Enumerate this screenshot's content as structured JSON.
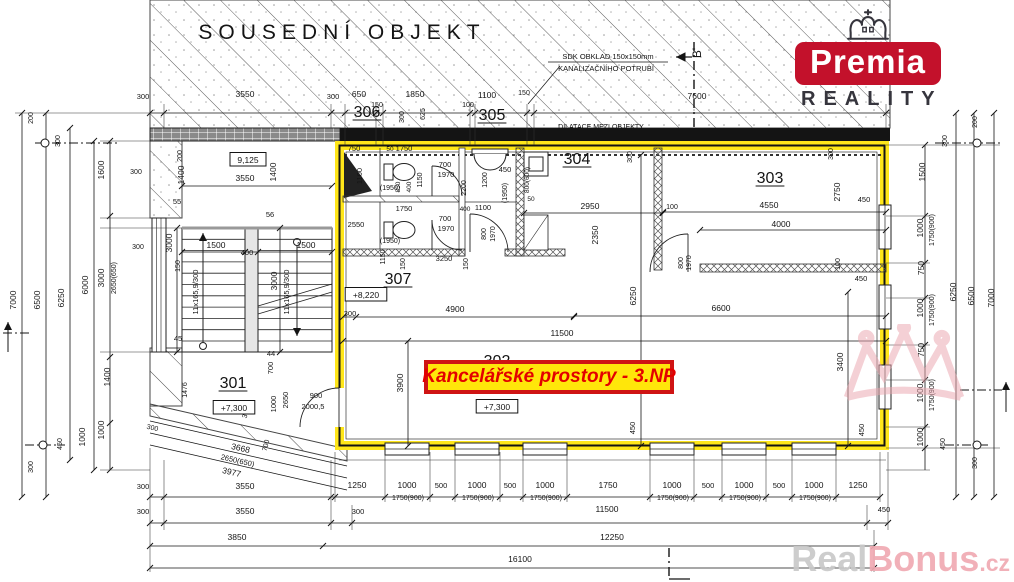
{
  "logo": {
    "name": "Premia",
    "subtitle": "REALITY"
  },
  "label": {
    "text": "Kancelářské prostory - 3.NP"
  },
  "watermark": {
    "part1": "Real",
    "part2": "Bonus",
    "part3": ".cz"
  },
  "colors": {
    "highlight_yellow": "#ffe61a",
    "label_border": "#cf1414",
    "label_text": "#e30000",
    "logo_red": "#c3112b",
    "logo_dark": "#36353d",
    "watermark_gray": "#c9c9c9",
    "watermark_pink": "#f0aab2",
    "line_dark": "#141414"
  },
  "texts": [
    {
      "t": "SOUSEDNÍ OBJEKT",
      "x": 342,
      "y": 39,
      "s": 21,
      "c": "#4d4d4d",
      "ls": 6,
      "n": "neighbor-building-label"
    },
    {
      "t": "SDK OBKLAD 150x150mm",
      "x": 608,
      "y": 59,
      "s": 7.5,
      "n": "note-sdk-cladding"
    },
    {
      "t": "KANALIZAČNÍHO POTRUBÍ",
      "x": 606,
      "y": 71,
      "s": 7.5,
      "n": "note-sewer-pipe"
    },
    {
      "t": "B'",
      "x": 701,
      "y": 53,
      "s": 12,
      "r": -90,
      "n": "section-marker-b"
    },
    {
      "t": "DILATACE MEZI OBJEKTY",
      "x": 601,
      "y": 129,
      "s": 7,
      "n": "note-dilatace"
    },
    {
      "t": "300",
      "x": 143,
      "y": 99,
      "s": 7.5
    },
    {
      "t": "3550",
      "x": 245,
      "y": 97
    },
    {
      "t": "300",
      "x": 333,
      "y": 99,
      "s": 7.5
    },
    {
      "t": "650",
      "x": 359,
      "y": 97
    },
    {
      "t": "150",
      "x": 377,
      "y": 107,
      "s": 7
    },
    {
      "t": "1850",
      "x": 415,
      "y": 97
    },
    {
      "t": "100",
      "x": 468,
      "y": 107,
      "s": 7
    },
    {
      "t": "1100",
      "x": 487,
      "y": 98
    },
    {
      "t": "150",
      "x": 524,
      "y": 95,
      "s": 7
    },
    {
      "t": "7600",
      "x": 697,
      "y": 99
    },
    {
      "t": "300",
      "x": 404,
      "y": 117,
      "r": -90,
      "s": 7
    },
    {
      "t": "625",
      "x": 425,
      "y": 114,
      "r": -90,
      "s": 7
    },
    {
      "t": "306",
      "x": 367,
      "y": 117,
      "s": 16,
      "u": 1,
      "n": "room-306"
    },
    {
      "t": "305",
      "x": 492,
      "y": 120,
      "s": 16,
      "u": 1,
      "n": "room-305"
    },
    {
      "t": "7000",
      "x": 16,
      "y": 300,
      "r": -90
    },
    {
      "t": "6500",
      "x": 40,
      "y": 300,
      "r": -90
    },
    {
      "t": "6250",
      "x": 64,
      "y": 298,
      "r": -90
    },
    {
      "t": "6000",
      "x": 88,
      "y": 285,
      "r": -90
    },
    {
      "t": "200",
      "x": 33,
      "y": 118,
      "r": -90,
      "s": 7
    },
    {
      "t": "300",
      "x": 60,
      "y": 141,
      "r": -90,
      "s": 7
    },
    {
      "t": "1600",
      "x": 104,
      "y": 170,
      "r": -90
    },
    {
      "t": "3000",
      "x": 104,
      "y": 278,
      "r": -90
    },
    {
      "t": "2650(650)",
      "x": 116,
      "y": 278,
      "r": -90,
      "s": 7
    },
    {
      "t": "1400",
      "x": 110,
      "y": 377,
      "r": -90
    },
    {
      "t": "1000",
      "x": 104,
      "y": 430,
      "r": -90
    },
    {
      "t": "1000",
      "x": 85,
      "y": 437,
      "r": -90
    },
    {
      "t": "450",
      "x": 62,
      "y": 444,
      "r": -90,
      "s": 7
    },
    {
      "t": "300",
      "x": 33,
      "y": 467,
      "r": -90,
      "s": 7
    },
    {
      "t": "300",
      "x": 136,
      "y": 174,
      "s": 7
    },
    {
      "t": "300",
      "x": 138,
      "y": 249,
      "s": 7
    },
    {
      "t": "200",
      "x": 977,
      "y": 122,
      "r": -90,
      "s": 7
    },
    {
      "t": "300",
      "x": 947,
      "y": 141,
      "r": -90,
      "s": 7
    },
    {
      "t": "1500",
      "x": 925,
      "y": 172,
      "r": -90
    },
    {
      "t": "1000",
      "x": 923,
      "y": 228,
      "r": -90
    },
    {
      "t": "1750(900)",
      "x": 934,
      "y": 230,
      "r": -90,
      "s": 7
    },
    {
      "t": "750",
      "x": 924,
      "y": 268,
      "r": -90
    },
    {
      "t": "1000",
      "x": 923,
      "y": 308,
      "r": -90
    },
    {
      "t": "1750(900)",
      "x": 934,
      "y": 310,
      "r": -90,
      "s": 7
    },
    {
      "t": "750",
      "x": 924,
      "y": 350,
      "r": -90
    },
    {
      "t": "1000",
      "x": 923,
      "y": 393,
      "r": -90
    },
    {
      "t": "1750(900)",
      "x": 934,
      "y": 395,
      "r": -90,
      "s": 7
    },
    {
      "t": "1000",
      "x": 923,
      "y": 437,
      "r": -90
    },
    {
      "t": "450",
      "x": 945,
      "y": 444,
      "r": -90,
      "s": 7
    },
    {
      "t": "300",
      "x": 977,
      "y": 463,
      "r": -90,
      "s": 7
    },
    {
      "t": "6250",
      "x": 956,
      "y": 292,
      "r": -90
    },
    {
      "t": "6500",
      "x": 974,
      "y": 296,
      "r": -90
    },
    {
      "t": "7000",
      "x": 994,
      "y": 298,
      "r": -90
    },
    {
      "t": "300",
      "x": 143,
      "y": 489,
      "s": 7.5
    },
    {
      "t": "3550",
      "x": 245,
      "y": 489
    },
    {
      "t": "1250",
      "x": 357,
      "y": 488
    },
    {
      "t": "1000",
      "x": 407,
      "y": 488
    },
    {
      "t": "1750(900)",
      "x": 408,
      "y": 500,
      "s": 7
    },
    {
      "t": "500",
      "x": 441,
      "y": 488,
      "s": 7.5
    },
    {
      "t": "1000",
      "x": 477,
      "y": 488
    },
    {
      "t": "1750(900)",
      "x": 478,
      "y": 500,
      "s": 7
    },
    {
      "t": "500",
      "x": 510,
      "y": 488,
      "s": 7.5
    },
    {
      "t": "1000",
      "x": 545,
      "y": 488
    },
    {
      "t": "1750(900)",
      "x": 546,
      "y": 500,
      "s": 7
    },
    {
      "t": "1750",
      "x": 608,
      "y": 488
    },
    {
      "t": "1000",
      "x": 672,
      "y": 488
    },
    {
      "t": "1750(900)",
      "x": 673,
      "y": 500,
      "s": 7
    },
    {
      "t": "500",
      "x": 708,
      "y": 488,
      "s": 7.5
    },
    {
      "t": "1000",
      "x": 744,
      "y": 488
    },
    {
      "t": "1750(900)",
      "x": 745,
      "y": 500,
      "s": 7
    },
    {
      "t": "500",
      "x": 779,
      "y": 488,
      "s": 7.5
    },
    {
      "t": "1000",
      "x": 814,
      "y": 488
    },
    {
      "t": "1750(900)",
      "x": 815,
      "y": 500,
      "s": 7
    },
    {
      "t": "1250",
      "x": 858,
      "y": 488
    },
    {
      "t": "300",
      "x": 143,
      "y": 514,
      "s": 7.5
    },
    {
      "t": "3550",
      "x": 245,
      "y": 514
    },
    {
      "t": "300",
      "x": 358,
      "y": 514,
      "s": 7.5
    },
    {
      "t": "11500",
      "x": 607,
      "y": 512
    },
    {
      "t": "450",
      "x": 884,
      "y": 512,
      "s": 7.5
    },
    {
      "t": "3850",
      "x": 237,
      "y": 540
    },
    {
      "t": "12250",
      "x": 612,
      "y": 540
    },
    {
      "t": "16100",
      "x": 520,
      "y": 562
    },
    {
      "t": "3668",
      "x": 240,
      "y": 451,
      "r": 13
    },
    {
      "t": "2650(650)",
      "x": 237,
      "y": 463,
      "r": 13,
      "s": 7.5
    },
    {
      "t": "3977",
      "x": 231,
      "y": 475,
      "r": 13
    },
    {
      "t": "300",
      "x": 152,
      "y": 430,
      "r": 13,
      "s": 7
    },
    {
      "t": "300",
      "x": 248,
      "y": 413,
      "r": -75,
      "s": 7
    },
    {
      "t": "700",
      "x": 268,
      "y": 446,
      "r": -75,
      "s": 7
    },
    {
      "t": "9,125",
      "x": 248,
      "y": 163,
      "b": 1,
      "n": "level-9125"
    },
    {
      "t": "3550",
      "x": 245,
      "y": 181
    },
    {
      "t": "200",
      "x": 182,
      "y": 156,
      "r": -90,
      "s": 7
    },
    {
      "t": "1400",
      "x": 184,
      "y": 175,
      "r": -90
    },
    {
      "t": "1400",
      "x": 276,
      "y": 172,
      "r": -90
    },
    {
      "t": "55",
      "x": 177,
      "y": 204,
      "s": 7.5
    },
    {
      "t": "56",
      "x": 270,
      "y": 217,
      "s": 7.5
    },
    {
      "t": "3000",
      "x": 172,
      "y": 243,
      "r": -90
    },
    {
      "t": "1500",
      "x": 216,
      "y": 248
    },
    {
      "t": "400",
      "x": 247,
      "y": 255,
      "s": 7.5
    },
    {
      "t": "1500",
      "x": 306,
      "y": 248
    },
    {
      "t": "150",
      "x": 180,
      "y": 266,
      "r": -90,
      "s": 7
    },
    {
      "t": "11x165,9/300",
      "x": 198,
      "y": 292,
      "r": -90,
      "s": 7.5,
      "n": "stair-spec"
    },
    {
      "t": "3000",
      "x": 277,
      "y": 281,
      "r": -90
    },
    {
      "t": "11x165,9/300",
      "x": 289,
      "y": 292,
      "r": -90,
      "s": 7.5,
      "n": "stair-spec"
    },
    {
      "t": "45",
      "x": 178,
      "y": 341,
      "s": 7.5
    },
    {
      "t": "44",
      "x": 271,
      "y": 356,
      "s": 7.5
    },
    {
      "t": "700",
      "x": 273,
      "y": 368,
      "r": -90,
      "s": 7.5
    },
    {
      "t": "1000",
      "x": 276,
      "y": 404,
      "r": -90,
      "s": 7.5
    },
    {
      "t": "2650",
      "x": 288,
      "y": 400,
      "r": -90,
      "s": 7.5
    },
    {
      "t": "1476",
      "x": 187,
      "y": 390,
      "r": -90,
      "s": 7
    },
    {
      "t": "301",
      "x": 233,
      "y": 388,
      "s": 16,
      "u": 1,
      "n": "room-301"
    },
    {
      "t": "+7,300",
      "x": 234,
      "y": 411,
      "b": 1,
      "n": "level-7300-room301"
    },
    {
      "t": "900",
      "x": 316,
      "y": 398,
      "s": 7.5
    },
    {
      "t": "2000,5",
      "x": 313,
      "y": 409,
      "s": 7.5
    },
    {
      "t": "750",
      "x": 354,
      "y": 151,
      "s": 7.5
    },
    {
      "t": "1100",
      "x": 362,
      "y": 176,
      "r": -90,
      "s": 7.5
    },
    {
      "t": "50",
      "x": 390,
      "y": 151,
      "s": 6.5
    },
    {
      "t": "1750",
      "x": 404,
      "y": 151,
      "s": 7.5
    },
    {
      "t": "(1950)",
      "x": 390,
      "y": 190,
      "s": 7
    },
    {
      "t": "850",
      "x": 400,
      "y": 187,
      "r": -90,
      "s": 6.5
    },
    {
      "t": "400",
      "x": 411,
      "y": 187,
      "r": -90,
      "s": 6.5
    },
    {
      "t": "1150",
      "x": 422,
      "y": 180,
      "r": -90,
      "s": 7
    },
    {
      "t": "700",
      "x": 445,
      "y": 167,
      "s": 7.5
    },
    {
      "t": "1970",
      "x": 446,
      "y": 177,
      "s": 7.5
    },
    {
      "t": "2200",
      "x": 466,
      "y": 188,
      "r": -90,
      "s": 7
    },
    {
      "t": "1200",
      "x": 487,
      "y": 180,
      "r": -90,
      "s": 7
    },
    {
      "t": "450",
      "x": 505,
      "y": 172,
      "s": 7.5
    },
    {
      "t": "(1950)",
      "x": 507,
      "y": 193,
      "r": -90,
      "s": 7
    },
    {
      "t": "800(600)",
      "x": 529,
      "y": 180,
      "r": -90,
      "s": 6.5
    },
    {
      "t": "50",
      "x": 531,
      "y": 201,
      "s": 6.5
    },
    {
      "t": "2550",
      "x": 356,
      "y": 227,
      "s": 7.5
    },
    {
      "t": "1750",
      "x": 404,
      "y": 211,
      "s": 7.5
    },
    {
      "t": "(1950)",
      "x": 390,
      "y": 243,
      "s": 7
    },
    {
      "t": "700",
      "x": 445,
      "y": 221,
      "s": 7.5
    },
    {
      "t": "1970",
      "x": 446,
      "y": 231,
      "s": 7.5
    },
    {
      "t": "400",
      "x": 465,
      "y": 211,
      "s": 6.5
    },
    {
      "t": "1100",
      "x": 483,
      "y": 210,
      "s": 7.5
    },
    {
      "t": "800",
      "x": 486,
      "y": 234,
      "r": -90,
      "s": 7
    },
    {
      "t": "1970",
      "x": 495,
      "y": 234,
      "r": -90,
      "s": 7
    },
    {
      "t": "1150",
      "x": 385,
      "y": 257,
      "r": -90,
      "s": 7
    },
    {
      "t": "3250",
      "x": 444,
      "y": 261,
      "s": 7.5
    },
    {
      "t": "150",
      "x": 405,
      "y": 264,
      "r": -90,
      "s": 7
    },
    {
      "t": "150",
      "x": 468,
      "y": 264,
      "r": -90,
      "s": 7
    },
    {
      "t": "307",
      "x": 398,
      "y": 284,
      "s": 16,
      "u": 1,
      "n": "room-307"
    },
    {
      "t": "+8,220",
      "x": 366,
      "y": 298,
      "b": 1,
      "n": "level-8220"
    },
    {
      "t": "4900",
      "x": 455,
      "y": 312
    },
    {
      "t": "300",
      "x": 350,
      "y": 316,
      "s": 7.5
    },
    {
      "t": "11500",
      "x": 562,
      "y": 336
    },
    {
      "t": "304",
      "x": 577,
      "y": 164,
      "s": 16,
      "u": 1,
      "n": "room-304"
    },
    {
      "t": "2950",
      "x": 590,
      "y": 209
    },
    {
      "t": "2350",
      "x": 598,
      "y": 235,
      "r": -90
    },
    {
      "t": "300",
      "x": 632,
      "y": 157,
      "r": -90,
      "s": 7
    },
    {
      "t": "100",
      "x": 672,
      "y": 209,
      "s": 7
    },
    {
      "t": "303",
      "x": 770,
      "y": 183,
      "s": 16,
      "u": 1,
      "n": "room-303"
    },
    {
      "t": "300",
      "x": 833,
      "y": 154,
      "r": -90,
      "s": 7
    },
    {
      "t": "2750",
      "x": 840,
      "y": 192,
      "r": -90
    },
    {
      "t": "450",
      "x": 864,
      "y": 202,
      "s": 7.5
    },
    {
      "t": "4550",
      "x": 769,
      "y": 208
    },
    {
      "t": "4000",
      "x": 781,
      "y": 227
    },
    {
      "t": "800",
      "x": 683,
      "y": 263,
      "r": -90,
      "s": 7
    },
    {
      "t": "1970",
      "x": 691,
      "y": 263,
      "r": -90,
      "s": 7
    },
    {
      "t": "100",
      "x": 840,
      "y": 264,
      "r": -90,
      "s": 7
    },
    {
      "t": "6250",
      "x": 636,
      "y": 296,
      "r": -90
    },
    {
      "t": "6600",
      "x": 721,
      "y": 311
    },
    {
      "t": "450",
      "x": 861,
      "y": 281,
      "s": 7.5
    },
    {
      "t": "3400",
      "x": 843,
      "y": 362,
      "r": -90
    },
    {
      "t": "450",
      "x": 635,
      "y": 428,
      "r": -90,
      "s": 7.5
    },
    {
      "t": "450",
      "x": 864,
      "y": 430,
      "r": -90,
      "s": 7.5
    },
    {
      "t": "3900",
      "x": 403,
      "y": 383,
      "r": -90
    },
    {
      "t": "302",
      "x": 497,
      "y": 366,
      "s": 16,
      "n": "room-302"
    },
    {
      "t": "+7,300",
      "x": 497,
      "y": 410,
      "b": 1,
      "n": "level-7300-room302"
    }
  ]
}
